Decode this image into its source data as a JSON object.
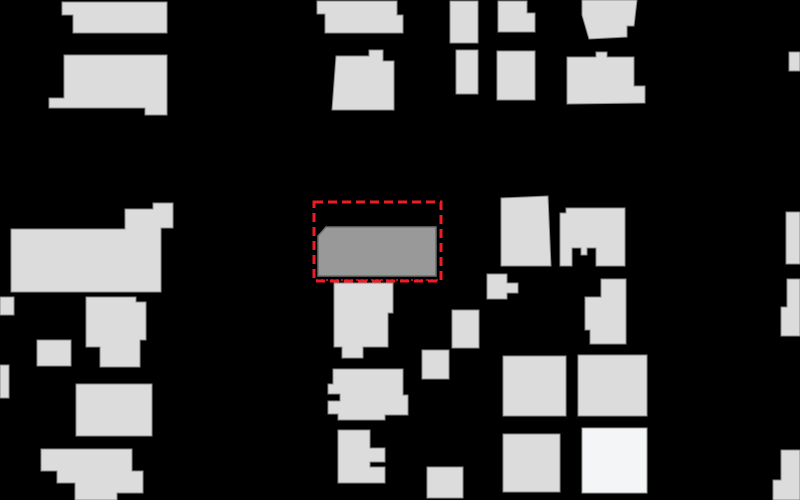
{
  "map": {
    "canvas": {
      "width": 800,
      "height": 500
    },
    "colors": {
      "background": "#000000",
      "building_fill": "#dcdcdc",
      "building_stroke": "#8a8a8a",
      "selected_fill": "#999999",
      "selected_stroke": "#6f6f6f",
      "bright_fill": "#f4f5f7",
      "bright_stroke": "#9a9a9a",
      "annotation": "#ee1c25"
    },
    "annotation_box": {
      "x": 314,
      "y": 202,
      "width": 127,
      "height": 79,
      "stroke_width": 3,
      "dash": "9,5",
      "bottom_dotted_line": {
        "x1": 316,
        "y1": 280,
        "x2": 440,
        "y2": 280,
        "stroke_width": 1.4,
        "dash": "2,3"
      }
    },
    "buildings": [
      {
        "id": "bldg-top-left-a",
        "type": "building",
        "points": "62,2 167,2 167,33 73,33 73,15 62,15"
      },
      {
        "id": "bldg-top-left-b",
        "type": "building",
        "points": "64,55 167,55 167,115 145,115 145,108 49,108 49,98 64,98"
      },
      {
        "id": "bldg-top-mid-a",
        "type": "building",
        "points": "317,1 397,1 397,15 403,15 403,33 325,33 325,14 317,14"
      },
      {
        "id": "bldg-top-mid-b",
        "type": "building",
        "points": "336,56 369,56 369,50 383,50 383,61 394,61 394,110 332,110"
      },
      {
        "id": "bldg-top-small-1",
        "type": "building",
        "points": "450,1 478,1 478,43 450,43"
      },
      {
        "id": "bldg-top-small-2",
        "type": "building",
        "points": "498,1 527,1 527,13 535,13 535,32 498,32"
      },
      {
        "id": "bldg-top-small-3",
        "type": "building",
        "points": "456,50 478,50 478,94 456,94"
      },
      {
        "id": "bldg-top-small-4",
        "type": "building",
        "points": "497,51 535,51 535,100 497,100"
      },
      {
        "id": "bldg-top-right-a",
        "type": "building",
        "points": "582,0 637,0 634,26 627,26 627,37 589,39 582,15"
      },
      {
        "id": "bldg-top-right-b",
        "type": "building",
        "points": "567,57 596,57 596,52 607,52 607,57 634,57 634,86 645,86 645,103 567,104"
      },
      {
        "id": "bldg-edge-right-1",
        "type": "building",
        "points": "789,52 800,52 800,71 789,71"
      },
      {
        "id": "bldg-mid-left-large",
        "type": "building",
        "points": "11,229 125,229 125,209 153,209 153,203 173,203 173,228 161,228 161,292 11,292"
      },
      {
        "id": "bldg-mid-left-small",
        "type": "building",
        "points": "86,297 136,297 136,302 146,302 146,340 140,340 140,367 100,367 100,347 86,347"
      },
      {
        "id": "bldg-edge-left-1",
        "type": "building",
        "points": "0,297 14,297 14,315 0,315"
      },
      {
        "id": "bldg-square-left",
        "type": "building",
        "points": "37,340 71,340 71,366 37,366"
      },
      {
        "id": "bldg-edge-left-2",
        "type": "building",
        "points": "0,365 9,365 9,398 0,398"
      },
      {
        "id": "bldg-lower-left",
        "type": "building",
        "points": "76,384 152,384 152,436 76,436"
      },
      {
        "id": "bldg-bottom-left",
        "type": "building",
        "points": "41,449 132,449 132,471 143,471 143,493 117,493 117,500 75,500 75,483 57,483 57,471 41,471"
      },
      {
        "id": "bldg-below-selected",
        "type": "building",
        "points": "334,283 393,283 393,313 388,313 388,347 363,347 363,358 342,358 342,347 334,347"
      },
      {
        "id": "bldg-center-lower",
        "type": "building",
        "points": "333,369 403,369 403,395 408,395 408,415 385,415 385,420 338,420 338,414 328,414 328,401 340,401 340,394 328,394 328,384 333,384"
      },
      {
        "id": "bldg-center-bottom",
        "type": "building",
        "points": "338,430 370,430 370,448 385,448 385,462 370,462 370,467 385,467 385,483 338,483"
      },
      {
        "id": "bldg-small-mid-1",
        "type": "building",
        "points": "487,274 507,274 507,283 518,283 518,293 507,293 507,299 487,299"
      },
      {
        "id": "bldg-small-mid-2",
        "type": "building",
        "points": "452,310 479,310 479,348 452,348"
      },
      {
        "id": "bldg-small-mid-3",
        "type": "building",
        "points": "422,350 449,350 449,379 422,379"
      },
      {
        "id": "bldg-right-mid-a",
        "type": "building",
        "points": "501,198 548,196 551,266 501,266"
      },
      {
        "id": "bldg-right-mid-b",
        "type": "building",
        "points": "566,208 625,208 625,266 596,266 596,248 587,248 587,255 581,255 581,248 572,248 572,266 560,266 560,213 566,213"
      },
      {
        "id": "bldg-right-mid-c",
        "type": "building",
        "points": "601,279 626,279 626,344 590,344 590,330 585,330 585,297 601,297"
      },
      {
        "id": "bldg-bottom-mid-a",
        "type": "building",
        "points": "503,356 566,356 566,416 503,416"
      },
      {
        "id": "bldg-bottom-mid-b",
        "type": "building",
        "points": "578,355 647,355 647,416 578,416"
      },
      {
        "id": "bldg-bottom-bright",
        "type": "bright",
        "points": "582,428 647,428 647,493 582,493"
      },
      {
        "id": "bldg-bottom-mid-c",
        "type": "building",
        "points": "503,434 560,434 560,492 503,492"
      },
      {
        "id": "bldg-bottom-square",
        "type": "building",
        "points": "427,467 463,467 463,498 427,498"
      },
      {
        "id": "bldg-edge-right-2",
        "type": "building",
        "points": "786,212 800,212 800,264 786,264"
      },
      {
        "id": "bldg-edge-right-3",
        "type": "building",
        "points": "787,279 800,279 800,336 781,336 781,307 787,307"
      },
      {
        "id": "bldg-corner-right",
        "type": "building",
        "points": "781,450 800,450 800,500 773,500 773,480 781,480"
      }
    ],
    "selected_building": {
      "id": "bldg-selected",
      "type": "selected",
      "points": "318,236 326,227 436,227 436,276 318,276"
    }
  }
}
